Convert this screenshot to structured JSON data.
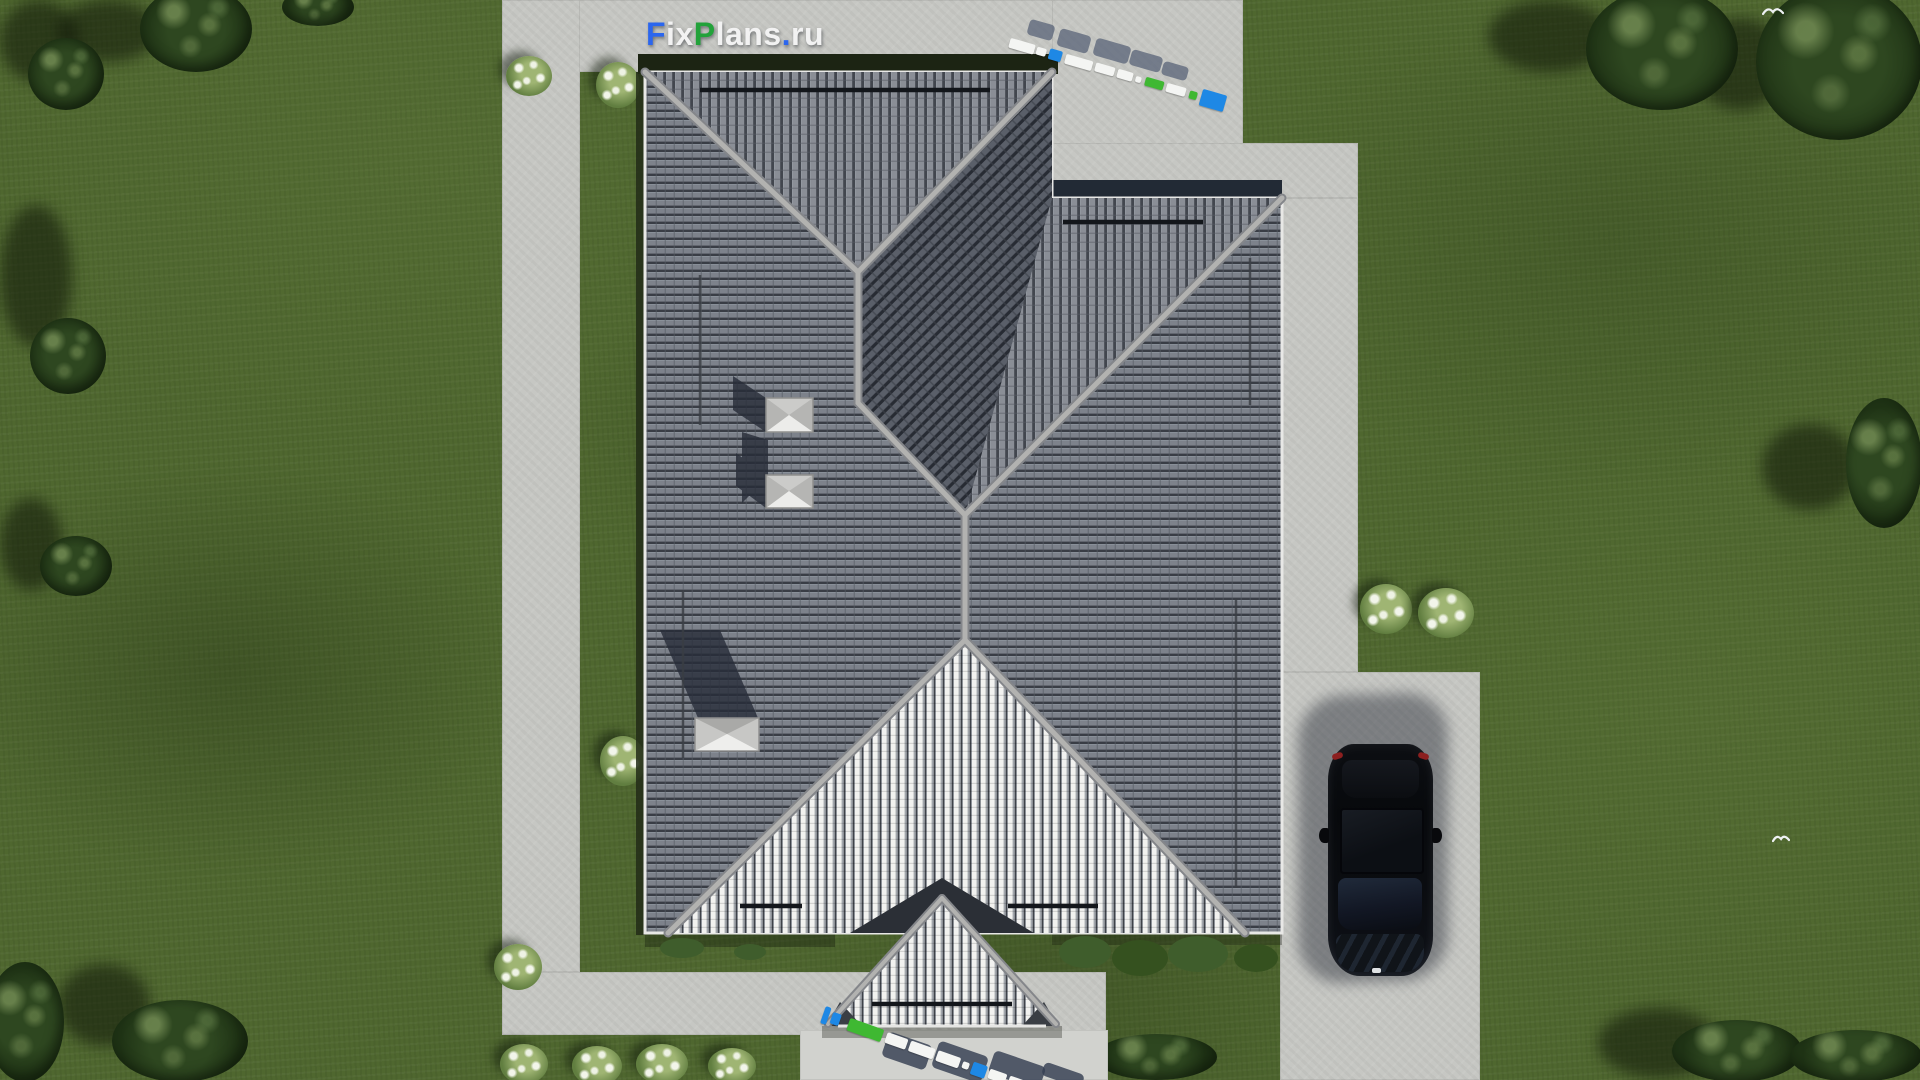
{
  "watermark": {
    "part1": "F",
    "part2": "ix",
    "part3": "P",
    "part4": "lans",
    "part5": ".",
    "part6": "ru"
  },
  "palette": {
    "grass": "#4f672f",
    "grassLight": "#5d7839",
    "concrete": "#c6c7c3",
    "concreteLight": "#d1d2ce",
    "roofBase": "#787d86",
    "roofCol": "#8a8e96",
    "roofDark": "#5a5f69",
    "roofBright": "#f2f2f0",
    "roofBrightBase": "#a2a6ac",
    "ridge": "#aeaeac",
    "hedge": "#1c2413",
    "car": "#0a0c10",
    "logoBlue": "#1e88e5",
    "logoGreen": "#3fb832",
    "logoWhite": "#f4f5f3",
    "watermarkBlue": "#2b66ee",
    "watermarkGreen": "#22a23a",
    "watermarkWhite": "#f2f2f2"
  },
  "logo3d_top": {
    "segments": [
      {
        "w": 26,
        "h": 10,
        "c": "#f4f5f3",
        "g": 0
      },
      {
        "w": 10,
        "h": 8,
        "c": "#f4f5f3",
        "g": 2
      },
      {
        "w": 13,
        "h": 11,
        "c": "#1e88e5",
        "g": 3
      },
      {
        "w": 28,
        "h": 10,
        "c": "#f4f5f3",
        "g": 4
      },
      {
        "w": 20,
        "h": 9,
        "c": "#f4f5f3",
        "g": 3
      },
      {
        "w": 16,
        "h": 9,
        "c": "#f4f5f3",
        "g": 3
      },
      {
        "w": 6,
        "h": 6,
        "c": "#f4f5f3",
        "g": 3
      },
      {
        "w": 19,
        "h": 9,
        "c": "#3fb832",
        "g": 4
      },
      {
        "w": 20,
        "h": 9,
        "c": "#f4f5f3",
        "g": 3
      },
      {
        "w": 8,
        "h": 8,
        "c": "#3fb832",
        "g": 4
      },
      {
        "w": 25,
        "h": 17,
        "c": "#1e88e5",
        "g": 4
      }
    ]
  },
  "logo3d_bottom": {
    "segments": [
      {
        "w": 6,
        "h": 18,
        "c": "#1e88e5",
        "g": 0
      },
      {
        "w": 9,
        "h": 12,
        "c": "#1e88e5",
        "g": 3
      },
      {
        "w": 36,
        "h": 13,
        "c": "#3fb832",
        "g": 9
      },
      {
        "w": 22,
        "h": 11,
        "c": "#f4f5f3",
        "g": 4
      },
      {
        "w": 26,
        "h": 11,
        "c": "#f4f5f3",
        "g": 3
      },
      {
        "w": 24,
        "h": 11,
        "c": "#f4f5f3",
        "g": 3
      },
      {
        "w": 7,
        "h": 7,
        "c": "#f4f5f3",
        "g": 3
      },
      {
        "w": 15,
        "h": 13,
        "c": "#1e88e5",
        "g": 3
      },
      {
        "w": 18,
        "h": 10,
        "c": "#f4f5f3",
        "g": 3
      },
      {
        "w": 24,
        "h": 11,
        "c": "#f4f5f3",
        "g": 3
      }
    ]
  }
}
